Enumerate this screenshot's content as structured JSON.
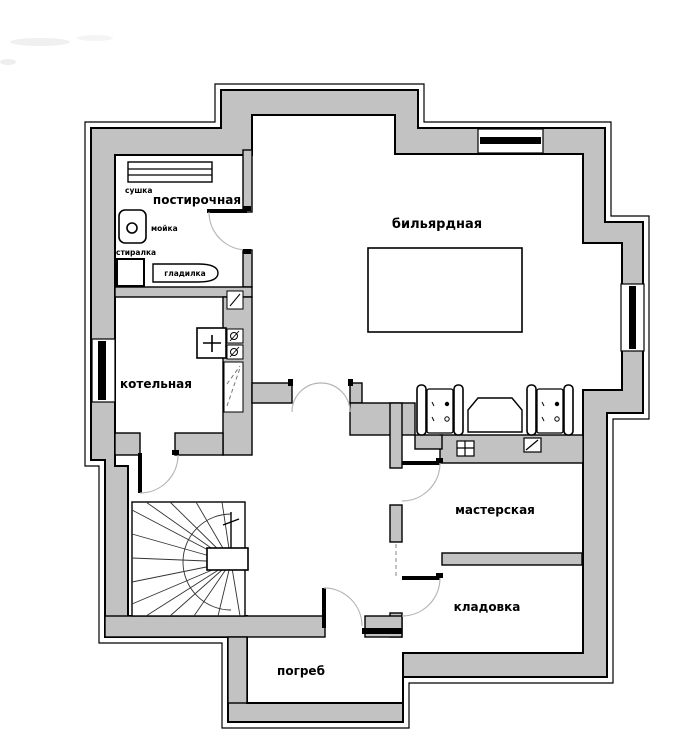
{
  "plan": {
    "type": "basement-floor-plan",
    "colors": {
      "wall_fill": "#c2c2c2",
      "outline": "#000000",
      "floor": "#ffffff",
      "door_arc": "#aaaaaa"
    },
    "rooms": {
      "laundry": {
        "label": "постирочная"
      },
      "billiard": {
        "label": "бильярдная"
      },
      "boiler": {
        "label": "котельная"
      },
      "workshop": {
        "label": "мастерская"
      },
      "storage": {
        "label": "кладовка"
      },
      "cellar": {
        "label": "погреб"
      }
    },
    "fixtures": {
      "dryer": {
        "label": "сушка"
      },
      "sink": {
        "label": "мойка"
      },
      "washer": {
        "label": "стиралка"
      },
      "ironing_board": {
        "label": "гладилка"
      }
    }
  }
}
